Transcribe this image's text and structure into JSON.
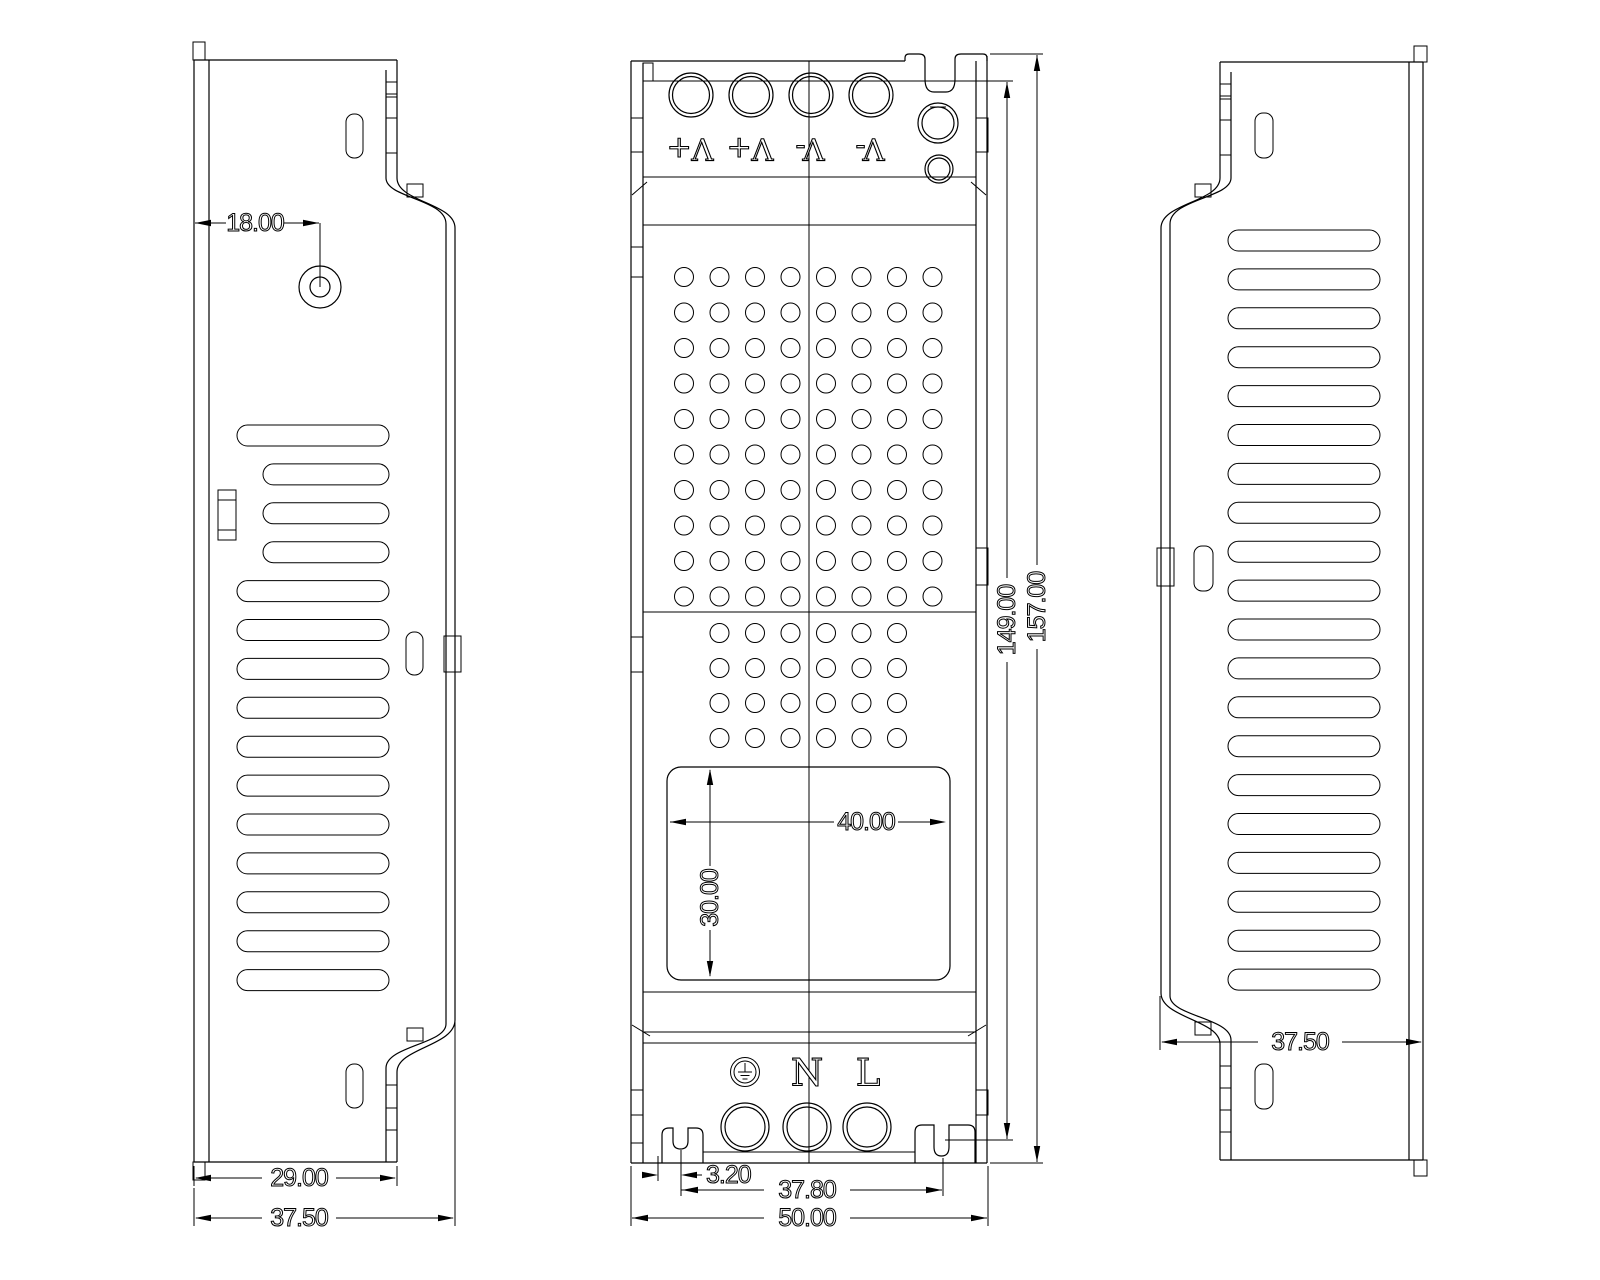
{
  "drawing": {
    "type": "engineering-drawing",
    "unit_style": "decimal-mm",
    "views": [
      "left-side-view",
      "front-view",
      "right-side-view"
    ]
  },
  "dims": {
    "left_hole_offset": "18.00",
    "left_inner_width": "29.00",
    "left_overall_width": "37.50",
    "label_width": "40.00",
    "label_height": "30.00",
    "slot_offset": "3.20",
    "slot_spacing": "37.80",
    "overall_width": "50.00",
    "inner_length": "149.00",
    "overall_length": "157.00",
    "right_overall_width": "37.50"
  },
  "terminals": {
    "output_labels": [
      "V+",
      "V+",
      "V-",
      "V-"
    ],
    "output_labels_note": "displayed rotated 180 degrees",
    "input": {
      "ground_icon": "earth-ground",
      "neutral": "N",
      "line": "L"
    }
  },
  "features": {
    "hole_grid_upper": {
      "cols": 8,
      "rows": 10
    },
    "hole_grid_lower": {
      "cols": 6,
      "rows": 4
    },
    "vent_slots_left": 15,
    "vent_slots_right": 20,
    "output_terminal_count": 4,
    "input_terminal_count": 3
  }
}
